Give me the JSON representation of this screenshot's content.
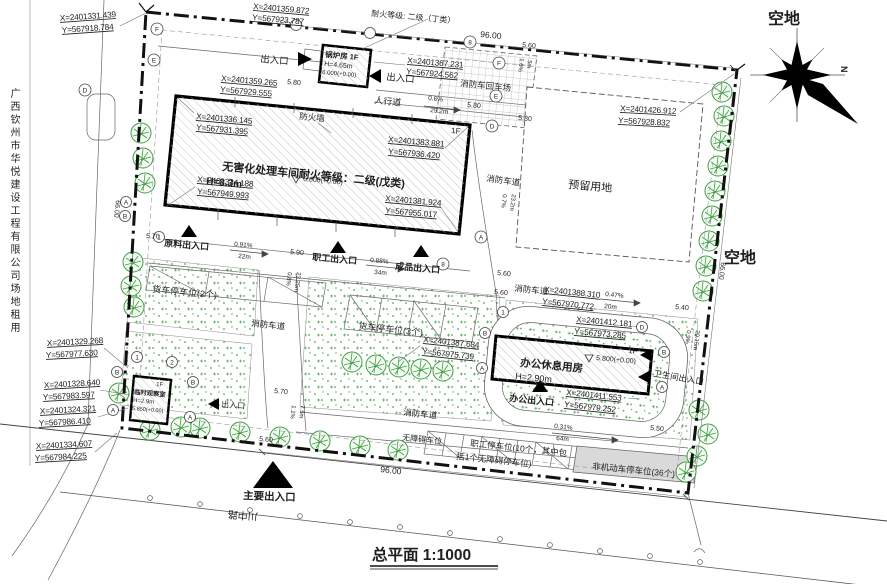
{
  "drawing": {
    "title": "总平面 1:1000",
    "side_note": "广西钦州市华悦建设工程有限公司场地租用",
    "road_name": "川中路",
    "north_label": "N",
    "vacant_top": "空地",
    "vacant_right": "空地",
    "fire_rating_note": "耐火等级: 二级（丁类）"
  },
  "buildings": {
    "workshop": {
      "label": "无害化处理车间耐火等级：二级(戊类)",
      "height": "H=8.3m",
      "elevation": "6.000(+0.00)",
      "floor": "1F",
      "firewall": "防火墙"
    },
    "boiler": {
      "label": "锅炉房 1F",
      "height": "H=4.65m",
      "elevation": "6.000(+0.00)"
    },
    "office": {
      "label": "办公休息用房",
      "height": "H=2.90m",
      "elevation": "5.800(+0.00)",
      "floor": "1F"
    },
    "observation": {
      "label": "临时观察室",
      "height": "H=2.9m",
      "elevation": "5.850(+0.00)",
      "floor": "1F"
    },
    "reserved": {
      "label": "预留用地"
    }
  },
  "roads": {
    "fire_lane": "消防车道",
    "turnaround": "消防车回车场",
    "sidewalk": "人行道"
  },
  "entrances": {
    "main": "主要出入口",
    "generic": "出入口",
    "material": "原料出入口",
    "staff": "职工出入口",
    "product": "成品出入口",
    "office": "办公出入口",
    "toilet": "卫生间出入口"
  },
  "parking": {
    "truck2": "货车停车位(2个)",
    "truck3": "货车停车位(3个)",
    "accessible": "无障碍车位",
    "staff_line1": "职工停车位(10个，其中包",
    "staff_line2": "括1个无障碍停车位)",
    "bike": "非机动车停车位(36个)"
  },
  "dimensions": {
    "top": "96.00",
    "bottom": "96.00",
    "left": "66.00",
    "right": "66.00"
  },
  "elevations": {
    "e540": "5.40",
    "e550": "5.50",
    "e560": "5.60",
    "e570": "5.70",
    "e580": "5.80",
    "e590": "5.90"
  },
  "slopes": {
    "s1": {
      "v": "0.6%",
      "l": "29.2m"
    },
    "s2": {
      "v": "0.91%",
      "l": "22m"
    },
    "s3": {
      "v": "0.88%",
      "l": "34m"
    },
    "s4": {
      "v": "0.47%",
      "l": "20m"
    },
    "s5": {
      "v": "0.31%",
      "l": "64m"
    },
    "s6": {
      "v": "0.8%",
      "l": "23.25m"
    },
    "s7": {
      "v": "0.7%",
      "l": "23.2m"
    },
    "s8": {
      "v": "1.6%",
      "l": "5m"
    },
    "s9": {
      "v": "0.9%",
      "l": "20.15m"
    },
    "s10": {
      "v": "1.1%",
      "l": "7.5m"
    }
  },
  "coords": {
    "c1": {
      "x": "X=2401331.439",
      "y": "Y=567918.784"
    },
    "c2": {
      "x": "X=2401359.872",
      "y": "Y=567923.787"
    },
    "c3": {
      "x": "X=2401359.265",
      "y": "Y=567929.555"
    },
    "c4": {
      "x": "X=2401367.231",
      "y": "Y=567924.562"
    },
    "c5": {
      "x": "X=2401426.912",
      "y": "Y=567928.832"
    },
    "c6": {
      "x": "X=2401336.145",
      "y": "Y=567931.395"
    },
    "c7": {
      "x": "X=2401383.881",
      "y": "Y=567936.420"
    },
    "c8": {
      "x": "X=2401334.188",
      "y": "Y=567949.993"
    },
    "c9": {
      "x": "X=2401381.924",
      "y": "Y=567955.017"
    },
    "c10": {
      "x": "X=2401329.268",
      "y": "Y=567977.630"
    },
    "c11": {
      "x": "X=2401328.640",
      "y": "Y=567983.597"
    },
    "c12": {
      "x": "X=2401324.321",
      "y": "Y=567986.410"
    },
    "c13": {
      "x": "X=2401334.607",
      "y": "Y=567984.225"
    },
    "c14": {
      "x": "X=2401388.310",
      "y": "Y=567970.772"
    },
    "c15": {
      "x": "X=2401387.684",
      "y": "Y=567975.739"
    },
    "c16": {
      "x": "X=2401412.181",
      "y": "Y=567973.285"
    },
    "c17": {
      "x": "X=2401411.553",
      "y": "Y=567979.252"
    }
  },
  "grid": {
    "a": "A",
    "b": "B",
    "d": "D",
    "e": "E",
    "f": "F",
    "n1": "1",
    "n2": "2",
    "n8": "8"
  },
  "colors": {
    "tree": "#3f9e3f",
    "grass_dot": "#4aa84a",
    "bike_area": "#d9d9d9"
  }
}
